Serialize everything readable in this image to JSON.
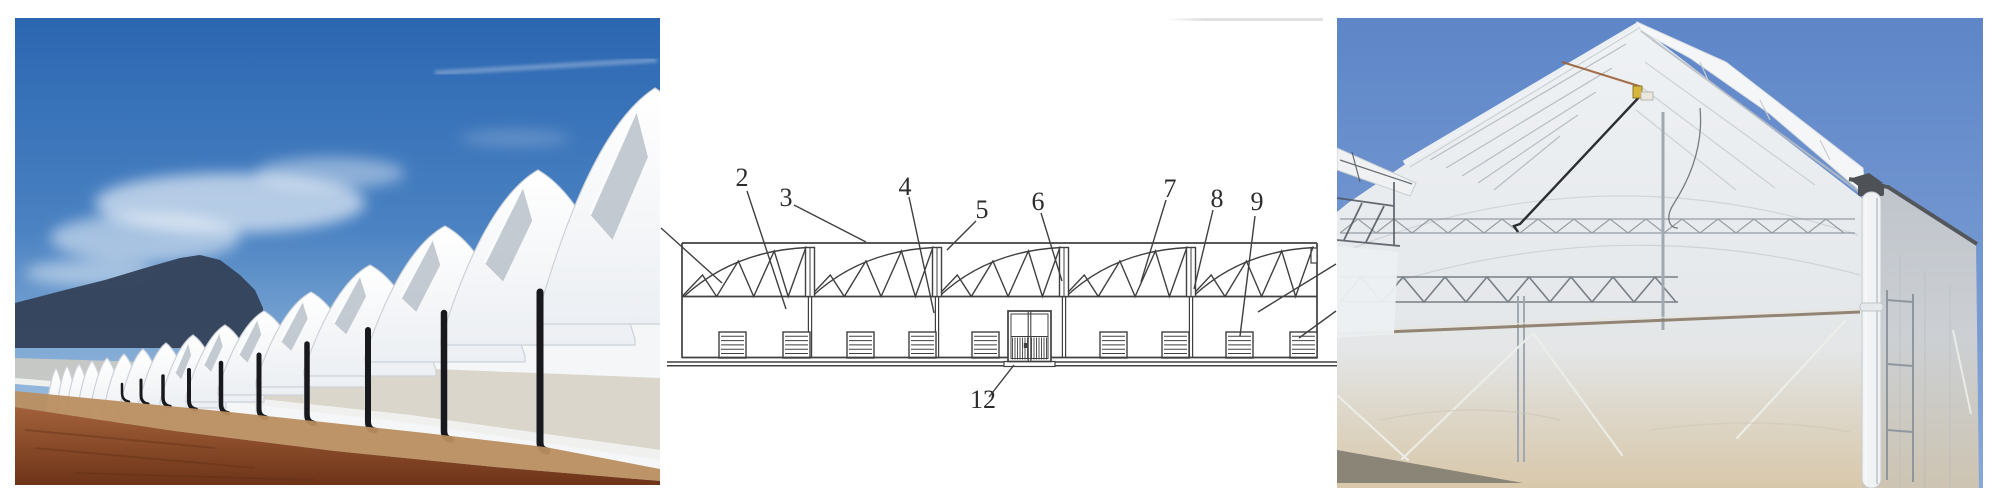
{
  "figure": {
    "type": "three-panel-greenhouse-figure",
    "panel_count": 3
  },
  "palette": {
    "paper": "#ffffff",
    "ink": "#404040",
    "faintStrip": "#d8d9db",
    "skyTop": "#2b66b1",
    "skyMid": "#4a82c2",
    "skyLow": "#9cbede",
    "cloud": "#ffffff",
    "mountain": "#33435a",
    "film": "#f4f6f8",
    "filmEdge": "#ccd2d9",
    "notch": "#bcc3cb",
    "pipeBlack": "#17191c",
    "band": "#d5cec1",
    "baseStrip": "#f0f1ef",
    "pathTan": "#b98e5f",
    "dirtDark": "#6e3418",
    "dirtLight": "#a2613a",
    "rSkyTop": "#5e86c8",
    "rSkyLow": "#87a7d8",
    "rFilm": "#eceff2",
    "rSand": "#d8c4a2",
    "rFrame": "#a9b2ba",
    "rDark": "#4e5256",
    "rRail": "#8a7a66",
    "rRope": "#eceee9",
    "rPipe": "#f0f2f3",
    "rCable": "#2b2e31",
    "rYellow": "#d6b53c"
  },
  "left_photo": {
    "description": "Row of multi-span arched plastic-film greenhouses receding to the left under a blue sky, dark mountain ridge behind, black rain downpipes on the gable posts, beige shade band on the walls and a brown earth road in the foreground"
  },
  "diagram": {
    "description": "Front elevation drawing of a multi-span greenhouse: five arched truss roof bays over a continuous side wall with nine louvered vents and a central hatched double door on a double ground line",
    "labels": [
      {
        "text": "2"
      },
      {
        "text": "3"
      },
      {
        "text": "4"
      },
      {
        "text": "5"
      },
      {
        "text": "6"
      },
      {
        "text": "7"
      },
      {
        "text": "8"
      },
      {
        "text": "9"
      },
      {
        "text": "12"
      }
    ]
  },
  "right_photo": {
    "description": "Close-up of a plastic-film greenhouse gable end with rolled-film ridge cap, black tensioning cable, yellow pulley, steel trusses visible through translucent film, white corner downpipe and dusty film skirt with guy ropes"
  }
}
